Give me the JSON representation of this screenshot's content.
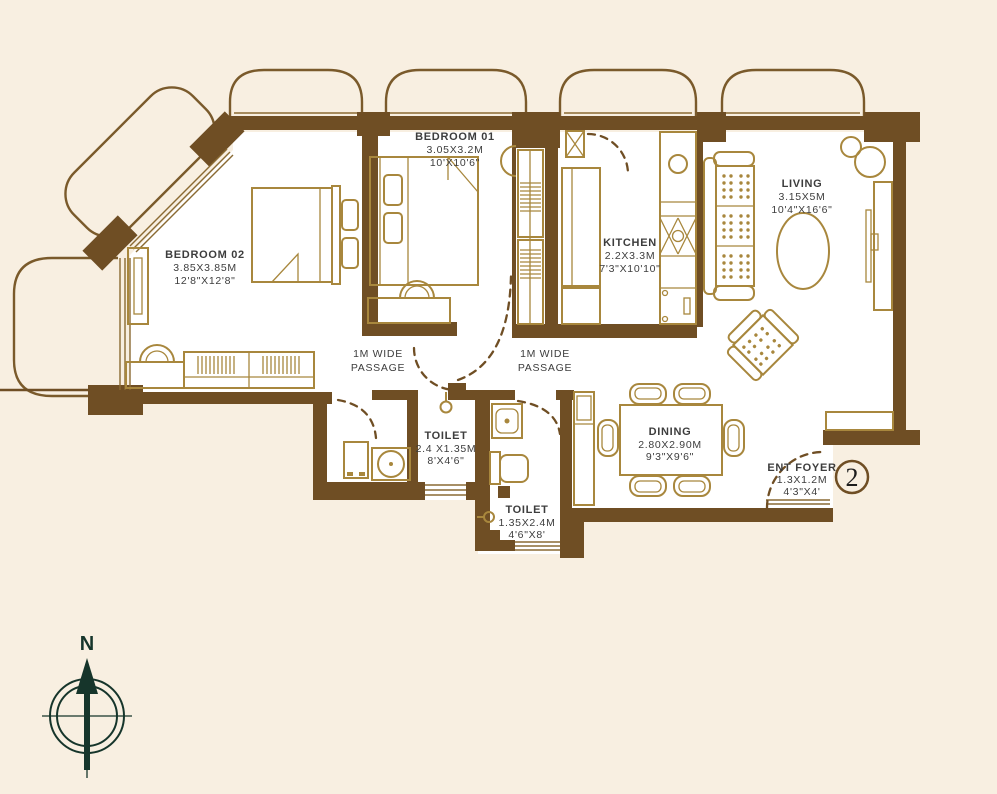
{
  "colors": {
    "background": "#f8efe1",
    "wall": "#6f4e24",
    "furniture": "#a8873d",
    "text": "#3d3d3d",
    "compass": "#16352b",
    "badge_text": "#1d1d1d"
  },
  "rooms": {
    "bedroom01": {
      "name": "BEDROOM 01",
      "metric": "3.05X3.2M",
      "imperial": "10'X10'6\""
    },
    "bedroom02": {
      "name": "BEDROOM 02",
      "metric": "3.85X3.85M",
      "imperial": "12'8\"X12'8\""
    },
    "kitchen": {
      "name": "KITCHEN",
      "metric": "2.2X3.3M",
      "imperial": "7'3\"X10'10\""
    },
    "living": {
      "name": "LIVING",
      "metric": "3.15X5M",
      "imperial": "10'4\"X16'6\""
    },
    "dining": {
      "name": "DINING",
      "metric": "2.80X2.90M",
      "imperial": "9'3\"X9'6\""
    },
    "toilet1": {
      "name": "TOILET",
      "metric": "2.4 X1.35M",
      "imperial": "8'X4'6\""
    },
    "toilet2": {
      "name": "TOILET",
      "metric": "1.35X2.4M",
      "imperial": "4'6\"X8'"
    },
    "ent_foyer": {
      "name": "ENT FOYER",
      "metric": "1.3X1.2M",
      "imperial": "4'3\"X4'"
    }
  },
  "passages": {
    "vertical": {
      "line1": "1M WIDE",
      "line2": "PASSAGE"
    },
    "horizontal": {
      "line1": "1M WIDE",
      "line2": "PASSAGE"
    }
  },
  "unit_number": "2",
  "compass_label": "N"
}
